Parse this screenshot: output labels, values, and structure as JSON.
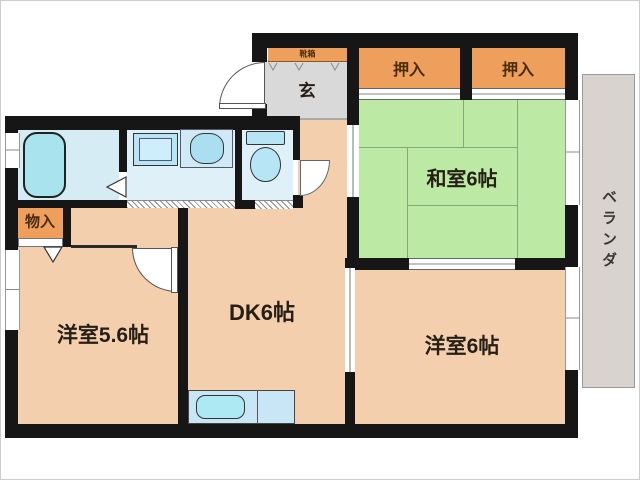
{
  "plan": {
    "type": "floor-plan",
    "rooms": {
      "entrance": {
        "label": "玄"
      },
      "shoe_cabinet": {
        "label": "靴箱"
      },
      "closet_left": {
        "label": "押入"
      },
      "closet_right": {
        "label": "押入"
      },
      "japanese_room": {
        "label": "和室6帖"
      },
      "storage": {
        "label": "物入"
      },
      "western_room_small": {
        "label": "洋室5.6帖"
      },
      "dining_kitchen": {
        "label": "DK6帖"
      },
      "western_room_large": {
        "label": "洋室6帖"
      },
      "veranda": {
        "label": "ベランダ"
      }
    },
    "fixtures": [
      "bathtub",
      "washing-machine-pan",
      "wash-basin",
      "toilet",
      "kitchen-counter",
      "kitchen-sink"
    ],
    "palette": {
      "wall": "#161616",
      "room_floor": "#f4cfae",
      "closet_orange": "#ef9f5c",
      "tatami_green": "#bce9a3",
      "wet_area_blue": "#dff0f9",
      "fixture_blue": "#b2e5f3",
      "entrance_gray": "#d9d9d9",
      "veranda_gray": "#d8d3cf"
    }
  }
}
